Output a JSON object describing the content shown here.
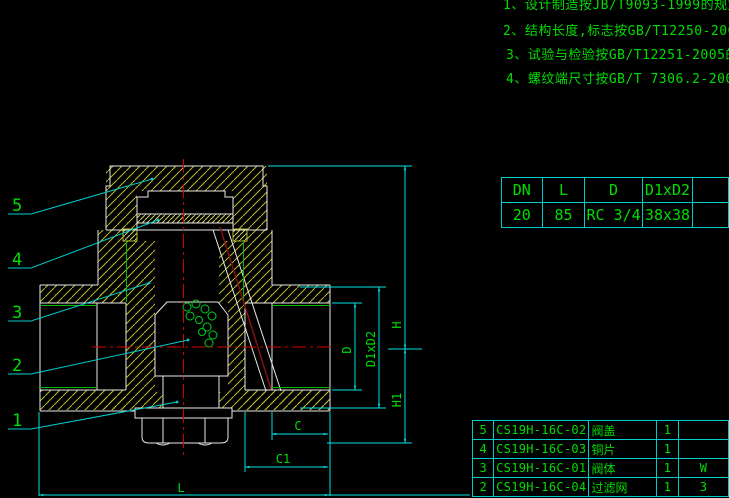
{
  "notes": [
    "1、设计制造按JB/T9093-1999的规定",
    "2、结构长度,标志按GB/T12250-2005的规定",
    "3、试验与检验按GB/T12251-2005的规定",
    "4、螺纹端尺寸按GB/T 7306.2-2000的规定"
  ],
  "spec_table": {
    "headers": [
      "DN",
      "L",
      "D",
      "D1xD2"
    ],
    "values": [
      "20",
      "85",
      "RC 3/4",
      "38x38"
    ]
  },
  "parts_table": {
    "rows": [
      {
        "no": "5",
        "code": "CS19H-16C-02",
        "name": "阀盖",
        "qty": "1",
        "material": ""
      },
      {
        "no": "4",
        "code": "CS19H-16C-03",
        "name": "铜片",
        "qty": "1",
        "material": ""
      },
      {
        "no": "3",
        "code": "CS19H-16C-01",
        "name": "阀体",
        "qty": "1",
        "material": "W"
      },
      {
        "no": "2",
        "code": "CS19H-16C-04",
        "name": "过滤网",
        "qty": "1",
        "material": "3"
      }
    ]
  },
  "dimensions": {
    "height_total": "H",
    "height_lower": "H1",
    "bore": "D",
    "port_square": "D1xD2",
    "c": "C",
    "c1": "C1",
    "length": "L"
  },
  "callouts": {
    "c5": "5",
    "c4": "4",
    "c3": "3",
    "c2": "2",
    "c1": "1"
  },
  "colors": {
    "background": "#000000",
    "outline": "#e8e8e8",
    "hatch": "#b9b92e",
    "dimension_line": "#00e5e5",
    "annotation_text": "#00dd00",
    "centerline": "#d40000"
  }
}
